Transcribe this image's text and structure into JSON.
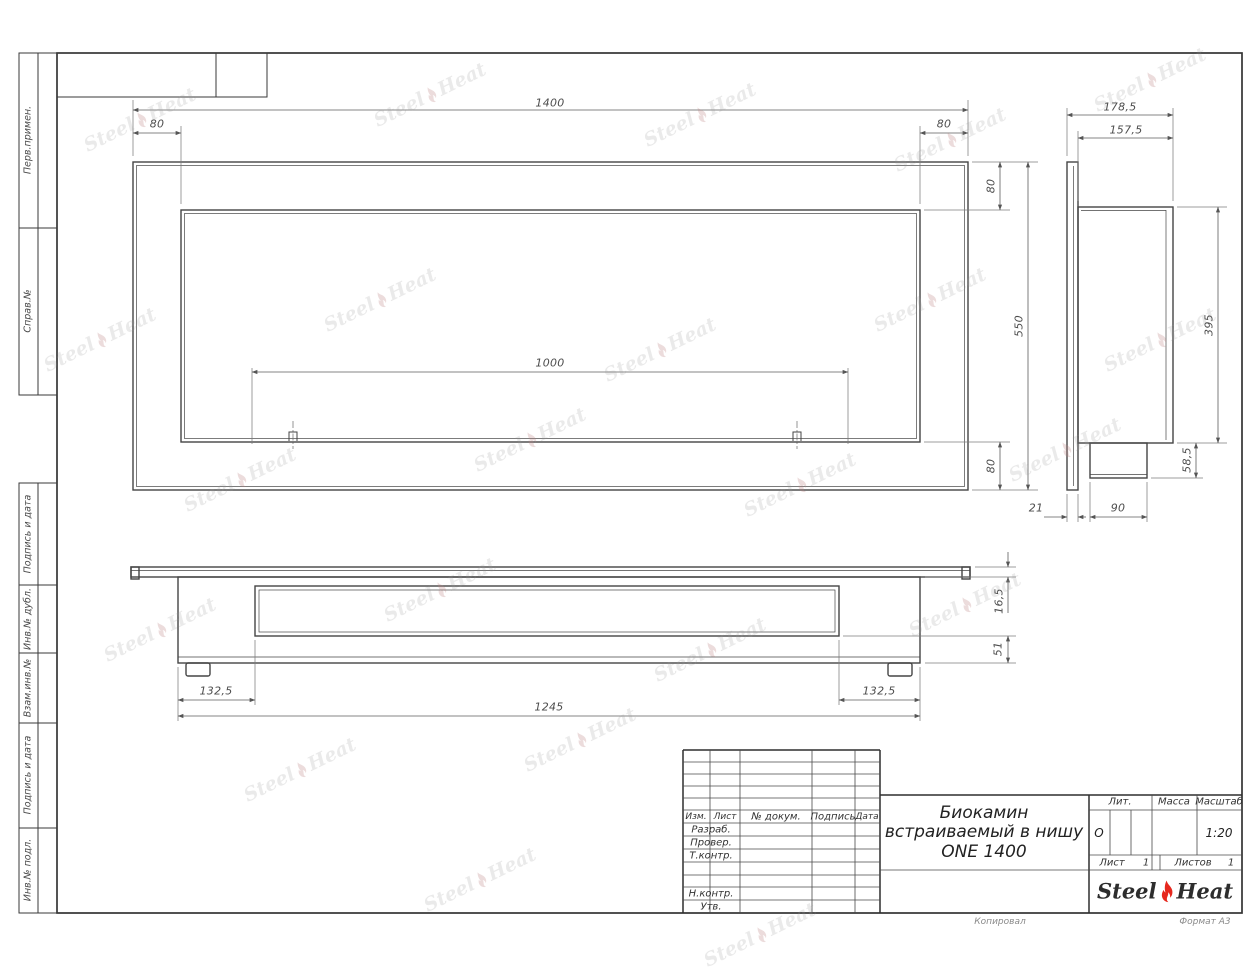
{
  "watermark": {
    "steel": "Steel",
    "heat": "Heat"
  },
  "sidebar": {
    "items": [
      {
        "label": "Перв.примен."
      },
      {
        "label": "Справ.№"
      },
      {
        "label": "Подпись и дата"
      },
      {
        "label": "Инв.№ дубл."
      },
      {
        "label": "Взам.инв.№"
      },
      {
        "label": "Подпись и дата"
      },
      {
        "label": "Инв.№ подл."
      }
    ]
  },
  "dims": {
    "front_width": "1400",
    "front_inset_left": "80",
    "front_inset_right": "80",
    "front_opening": "1000",
    "front_inset_top": "80",
    "front_height": "550",
    "front_inset_bottom": "80",
    "side_depth": "178,5",
    "side_body_depth": "157,5",
    "side_body_height": "395",
    "side_bottom_height": "58,5",
    "side_flange_gap": "21",
    "side_box_depth": "90",
    "bottom_flange": "16,5",
    "bottom_leg": "51",
    "bottom_inset_left": "132,5",
    "bottom_body_width": "1245",
    "bottom_inset_right": "132,5"
  },
  "title_block": {
    "col_izm": "Изм.",
    "col_list": "Лист",
    "col_doc": "№ докум.",
    "col_sign": "Подпись",
    "col_date": "Дата",
    "row_razrab": "Разраб.",
    "row_prover": "Провер.",
    "row_tkontr": "Т.контр.",
    "row_nkontr": "Н.контр.",
    "row_utv": "Утв.",
    "title_line1": "Биокамин",
    "title_line2": "встраиваемый в нишу",
    "title_line3": "ONE 1400",
    "lit_label": "Лит.",
    "lit_value": "О",
    "mass_label": "Масса",
    "scale_label": "Масштаб",
    "scale_value": "1:20",
    "sheet_label": "Лист",
    "sheet_value": "1",
    "sheets_label": "Листов",
    "sheets_value": "1",
    "logo_steel": "Steel",
    "logo_heat": "Heat"
  },
  "footer": {
    "copied": "Копировал",
    "format": "Формат А3"
  }
}
